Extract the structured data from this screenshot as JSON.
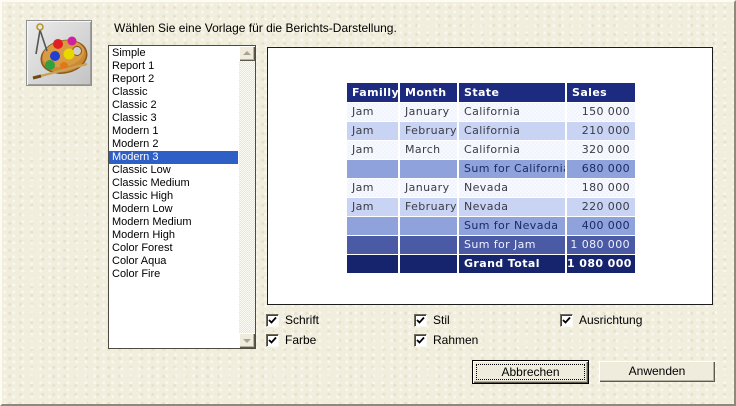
{
  "dialog": {
    "instruction": "Wählen Sie eine Vorlage für die Berichts-Darstellung.",
    "background_color": "#f1eedd"
  },
  "template_list": {
    "items": [
      "Simple",
      "Report 1",
      "Report 2",
      "Classic",
      "Classic 2",
      "Classic 3",
      "Modern 1",
      "Modern 2",
      "Modern 3",
      "Classic Low",
      "Classic Medium",
      "Classic High",
      "Modern Low",
      "Modern Medium",
      "Modern High",
      "Color Forest",
      "Color Aqua",
      "Color Fire"
    ],
    "selected_item": "Modern 3",
    "selected_index": 8,
    "selection_color": "#2d5fc6"
  },
  "preview": {
    "table": {
      "headers": [
        "Familly",
        "Month",
        "State",
        "Sales"
      ],
      "rows": [
        [
          "Jam",
          "January",
          "California",
          "150 000"
        ],
        [
          "Jam",
          "February",
          "California",
          "210 000"
        ],
        [
          "Jam",
          "March",
          "California",
          "320 000"
        ],
        [
          "",
          "",
          "Sum for California",
          "680 000"
        ],
        [
          "Jam",
          "January",
          "Nevada",
          "180 000"
        ],
        [
          "Jam",
          "February",
          "Nevada",
          "220 000"
        ],
        [
          "",
          "",
          "Sum for Nevada",
          "400 000"
        ],
        [
          "",
          "",
          "Sum for Jam",
          "1 080 000"
        ],
        [
          "",
          "",
          "Grand Total",
          "1 080 000"
        ]
      ],
      "row_styles": [
        "light",
        "alt",
        "light",
        "sum",
        "light",
        "alt",
        "sum",
        "sum2",
        "total"
      ],
      "colors": {
        "header_bg": "#1c2b80",
        "row_light_bg": "#f2f5fd",
        "row_alt_bg": "#c9d4f4",
        "row_sum_bg": "#8fa2dc",
        "row_sum2_bg": "#4a5aa4",
        "row_total_bg": "#16246e"
      }
    }
  },
  "options": [
    {
      "label": "Schrift",
      "checked": true
    },
    {
      "label": "Stil",
      "checked": true
    },
    {
      "label": "Ausrichtung",
      "checked": true
    },
    {
      "label": "Farbe",
      "checked": true
    },
    {
      "label": "Rahmen",
      "checked": true
    }
  ],
  "buttons": {
    "cancel_label": "Abbrechen",
    "apply_label": "Anwenden"
  }
}
